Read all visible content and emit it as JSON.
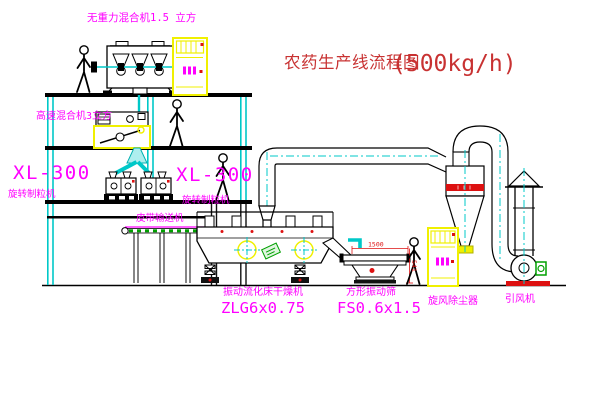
{
  "title": {
    "text": "农药生产线流程图",
    "capacity": "(500kg/h)"
  },
  "equipment_labels": {
    "gravity_free_mixer": "无重力混合机1.5 立方",
    "high_speed_mixer": "高速混合机3立方",
    "granulator_left_model": "XL-300",
    "granulator_left_name": "旋转制粒机",
    "granulator_right_model": "XL-300",
    "granulator_right_name": "旋转制粒机",
    "belt_conveyor": "皮带输送机",
    "fluid_bed_dryer_name": "振动流化床干燥机",
    "fluid_bed_dryer_model": "ZLG6x0.75",
    "square_sieve_name": "方形振动筛",
    "square_sieve_model": "FS0.6x1.5",
    "cyclone_dust_collector": "旋风除尘器",
    "induced_draft_fan": "引风机"
  },
  "dimensions": {
    "sieve_length": "1500",
    "sieve_height": "541"
  },
  "colors": {
    "line_cyan": "#00c8c8",
    "label_magenta": "#ff00ff",
    "title_red": "#c83232",
    "highlight_yellow": "#f0f000",
    "accent_green": "#00a000",
    "accent_red": "#dd1111"
  }
}
